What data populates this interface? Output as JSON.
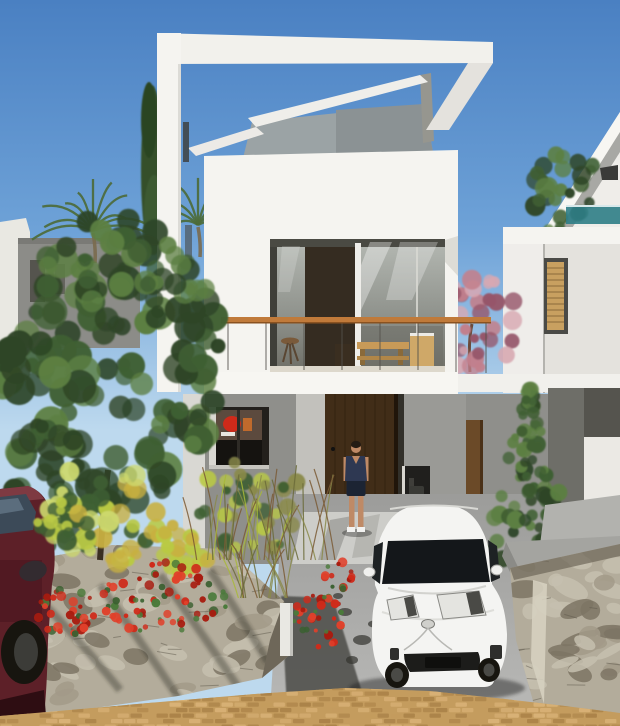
{
  "meta": {
    "title": "Architectural rendering - modern two-storey white villa with roof pergola, balcony, garden and parked cars",
    "width": 620,
    "height": 726
  },
  "scene": {
    "sky": {
      "top": "#4a80c2",
      "mid": "#6fa3d8",
      "bottom": "#bdd9ee"
    },
    "house": {
      "wall_white": "#f5f4f0",
      "pergola_white": "#f2f1ec",
      "pergola_shade": "#e4e2dd",
      "bulkhead_gray": "#9ba3a5",
      "slab_white": "#f7f6f2",
      "ground_shadow_wall": "#8f8f8b",
      "recess_wall": "#c2c1bc",
      "door_brown": "#412d18",
      "door_edge": "#20150a",
      "rail_wood": "#c07a3a",
      "glass_top": "#b4b8b2",
      "glass_mid": "#8d908a",
      "glass_dark": "#6e6e66",
      "dark_panel": "#352c21",
      "mullion": "#eeede9"
    },
    "neighbor_left": {
      "wall": "#8c8c88",
      "edge_white": "#e9e8e2",
      "window_dark": "#55544e"
    },
    "neighbor_right": {
      "wall": "#efede9",
      "fascia": "#f7f6f2",
      "shade": "#a8a8a4",
      "balustrade_teal": "#2e7d86",
      "louver_tan": "#c8a060",
      "dark_band": "#55544e",
      "lower_white": "#ebe9e4"
    },
    "vegetation": {
      "tree_dark": "#2e4527",
      "tree_mid": "#3f5f33",
      "tree_light": "#5c7f42",
      "bush_yellow": "#b9c944",
      "bush_lime": "#cdd96e",
      "bush_gold": "#c8b040",
      "grass_olive": "#8a8a4a",
      "flower_red": "#cf2a1a",
      "flower_red_dark": "#a81c10",
      "flower_red_light": "#e0402a",
      "leaf_green": "#4a7a3a",
      "pink_tree": "#c2808c",
      "pink_light": "#d8a8b2",
      "pink_dark": "#96566a",
      "palm_green": "#4d6b3a",
      "cypress_green": "#35502c"
    },
    "ground": {
      "driveway_top": "#9c9c9a",
      "driveway_bottom": "#b8b8b6",
      "walkway": "#cdcdc9",
      "cobble_tan": "#c49c5e",
      "cobble_dark": "#ab8349",
      "cobble_light": "#d9b277",
      "stone_wall": "#b3ac9b",
      "stone_light": "#c6bfaf",
      "stone_mid": "#a29a88",
      "stone_dark": "#7c7464",
      "crevice": "#5f594c",
      "concrete_cap": "#a4a4a0",
      "upper_terrace": "#b2b2ae",
      "shadow": "#4f4f4b"
    },
    "cars": {
      "white_body": "#f4f4f2",
      "windshield": "#14171a",
      "light_fill": "#e4e4e0",
      "grille": "#1c1c1a",
      "maroon_body": "#5d2028",
      "maroon_roof": "#7e3a42",
      "maroon_window": "#3c4a58",
      "tire": "#17150f"
    },
    "person": {
      "top": "#2e3852",
      "shorts": "#1c2433",
      "skin": "#bf8a66",
      "shoe": "#f2f2f0",
      "hair": "#241c14"
    }
  },
  "textures": {
    "palms": [
      {
        "target": "tex-palm-1",
        "cx": 93,
        "cy": 231,
        "r": 50,
        "n": 11
      },
      {
        "target": "tex-palm-2",
        "cx": 198,
        "cy": 225,
        "r": 40,
        "n": 9
      }
    ],
    "clusters": [
      {
        "target": "tex-neighbor-tree",
        "cx": 567,
        "cy": 198,
        "rx": 36,
        "ry": 48,
        "n": 30,
        "rmin": 5,
        "rmax": 11,
        "colors": [
          "scene.vegetation.tree_mid",
          "scene.vegetation.tree_light",
          "scene.vegetation.tree_dark"
        ]
      },
      {
        "target": "tex-pink-tree",
        "cx": 468,
        "cy": 322,
        "rx": 50,
        "ry": 54,
        "n": 44,
        "rmin": 4,
        "rmax": 10,
        "colors": [
          "scene.vegetation.pink_tree",
          "scene.vegetation.pink_light",
          "scene.vegetation.pink_dark"
        ]
      },
      {
        "target": "tex-left-tree",
        "cx": 108,
        "cy": 365,
        "rx": 112,
        "ry": 148,
        "n": 120,
        "rmin": 7,
        "rmax": 18,
        "colors": [
          "scene.vegetation.tree_dark",
          "scene.vegetation.tree_mid",
          "scene.vegetation.tree_light",
          "scene.vegetation.tree_dark"
        ]
      },
      {
        "target": "tex-left-tree",
        "cx": 60,
        "cy": 490,
        "rx": 60,
        "ry": 70,
        "n": 36,
        "rmin": 6,
        "rmax": 14,
        "colors": [
          "scene.vegetation.tree_dark",
          "scene.vegetation.tree_mid"
        ]
      },
      {
        "target": "tex-left-tree",
        "cx": 125,
        "cy": 280,
        "rx": 85,
        "ry": 45,
        "n": 32,
        "rmin": 6,
        "rmax": 13,
        "colors": [
          "scene.vegetation.tree_mid",
          "scene.vegetation.tree_dark",
          "scene.vegetation.tree_light"
        ]
      },
      {
        "target": "tex-bushes",
        "cx": 105,
        "cy": 512,
        "rx": 62,
        "ry": 52,
        "n": 50,
        "rmin": 5,
        "rmax": 11,
        "colors": [
          "scene.vegetation.bush_yellow",
          "scene.vegetation.bush_lime",
          "scene.vegetation.tree_mid",
          "scene.vegetation.bush_gold"
        ]
      },
      {
        "target": "tex-bushes",
        "cx": 185,
        "cy": 552,
        "rx": 30,
        "ry": 30,
        "n": 24,
        "rmin": 4,
        "rmax": 9,
        "colors": [
          "scene.vegetation.bush_gold",
          "scene.vegetation.bush_yellow"
        ]
      },
      {
        "target": "tex-bushes",
        "cx": 250,
        "cy": 505,
        "rx": 55,
        "ry": 48,
        "n": 32,
        "rmin": 4,
        "rmax": 9,
        "colors": [
          "scene.vegetation.grass_olive",
          "scene.vegetation.tree_mid",
          "scene.vegetation.bush_yellow"
        ]
      },
      {
        "target": "tex-overlap-leaves",
        "cx": 62,
        "cy": 522,
        "rx": 26,
        "ry": 22,
        "n": 14,
        "rmin": 4,
        "rmax": 8,
        "colors": [
          "scene.vegetation.tree_mid",
          "scene.vegetation.bush_yellow"
        ]
      },
      {
        "target": "tex-cone-tree",
        "cone": true,
        "apex": [
          529,
          386
        ],
        "baseY": 574,
        "halfw": 54,
        "n": 85,
        "rmin": 4,
        "rmax": 9,
        "colors": [
          "scene.vegetation.tree_dark",
          "scene.vegetation.tree_mid",
          "scene.vegetation.tree_light"
        ]
      }
    ],
    "flowers": [
      {
        "target": "tex-flowers",
        "cx": 160,
        "cy": 598,
        "rx": 70,
        "ry": 36,
        "n": 72
      },
      {
        "target": "tex-flowers",
        "cx": 66,
        "cy": 612,
        "rx": 30,
        "ry": 24,
        "n": 32
      },
      {
        "target": "tex-flowers",
        "cx": 318,
        "cy": 620,
        "rx": 25,
        "ry": 30,
        "n": 36
      },
      {
        "target": "tex-flowers",
        "cx": 338,
        "cy": 576,
        "rx": 15,
        "ry": 18,
        "n": 14
      }
    ],
    "grass": [
      {
        "target": "tex-grass",
        "x0": 196,
        "x1": 336,
        "baseY": 560,
        "n": 34,
        "hmin": 50,
        "hmax": 95
      },
      {
        "target": "tex-grass",
        "x0": 238,
        "x1": 300,
        "baseY": 598,
        "n": 16,
        "hmin": 35,
        "hmax": 60
      }
    ],
    "stones": [
      {
        "target": "tex-stones-left",
        "x0": 16,
        "x1": 290,
        "y0": 548,
        "y1": 712,
        "n": 54
      },
      {
        "target": "tex-stones-right",
        "x0": 512,
        "x1": 620,
        "y0": 548,
        "y1": 724,
        "n": 40
      }
    ],
    "cobbles": {
      "target": "tex-cobbles",
      "x0": -6,
      "x1": 626,
      "y0": 686,
      "y1": 728,
      "dx": 13,
      "dy": 5.5
    }
  }
}
